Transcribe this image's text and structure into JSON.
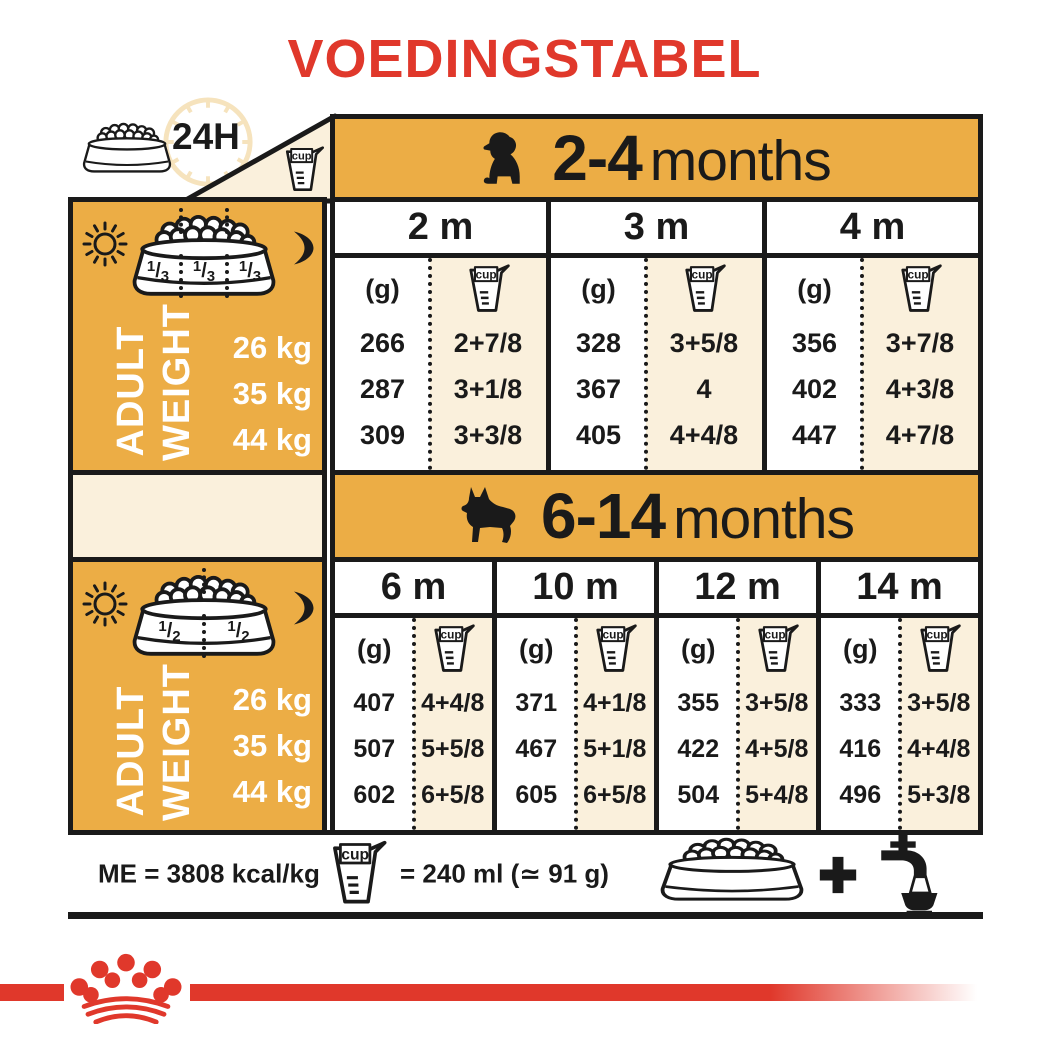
{
  "title": "VOEDINGSTABEL",
  "top_left": {
    "hours_label": "24H",
    "cup_label": "cup"
  },
  "row_header": {
    "line1": "ADULT",
    "line2": "WEIGHT"
  },
  "unit_g": "(g)",
  "sections": [
    {
      "age_bold": "2-4",
      "age_rest": "months",
      "dog_icon": "puppy-icon",
      "bowl_fractions": [
        "1/3",
        "1/3",
        "1/3"
      ],
      "weights": [
        "26 kg",
        "35 kg",
        "44 kg"
      ],
      "columns": [
        {
          "month": "2 m",
          "rows": [
            {
              "g": "266",
              "cup": "2+7/8"
            },
            {
              "g": "287",
              "cup": "3+1/8"
            },
            {
              "g": "309",
              "cup": "3+3/8"
            }
          ]
        },
        {
          "month": "3 m",
          "rows": [
            {
              "g": "328",
              "cup": "3+5/8"
            },
            {
              "g": "367",
              "cup": "4"
            },
            {
              "g": "405",
              "cup": "4+4/8"
            }
          ]
        },
        {
          "month": "4 m",
          "rows": [
            {
              "g": "356",
              "cup": "3+7/8"
            },
            {
              "g": "402",
              "cup": "4+3/8"
            },
            {
              "g": "447",
              "cup": "4+7/8"
            }
          ]
        }
      ]
    },
    {
      "age_bold": "6-14",
      "age_rest": "months",
      "dog_icon": "german-shepherd-icon",
      "bowl_fractions": [
        "1/2",
        "1/2"
      ],
      "weights": [
        "26 kg",
        "35 kg",
        "44 kg"
      ],
      "columns": [
        {
          "month": "6 m",
          "rows": [
            {
              "g": "407",
              "cup": "4+4/8"
            },
            {
              "g": "507",
              "cup": "5+5/8"
            },
            {
              "g": "602",
              "cup": "6+5/8"
            }
          ]
        },
        {
          "month": "10 m",
          "rows": [
            {
              "g": "371",
              "cup": "4+1/8"
            },
            {
              "g": "467",
              "cup": "5+1/8"
            },
            {
              "g": "605",
              "cup": "6+5/8"
            }
          ]
        },
        {
          "month": "12 m",
          "rows": [
            {
              "g": "355",
              "cup": "3+5/8"
            },
            {
              "g": "422",
              "cup": "4+5/8"
            },
            {
              "g": "504",
              "cup": "5+4/8"
            }
          ]
        },
        {
          "month": "14 m",
          "rows": [
            {
              "g": "333",
              "cup": "3+5/8"
            },
            {
              "g": "416",
              "cup": "4+4/8"
            },
            {
              "g": "496",
              "cup": "5+3/8"
            }
          ]
        }
      ]
    }
  ],
  "footer": {
    "me_label": "ME = 3808 kcal/kg",
    "cup_equiv": "= 240 ml (≃ 91 g)"
  },
  "colors": {
    "red": "#e0382b",
    "gold": "#ecad45",
    "cream": "#faf0dc",
    "ink": "#1a1a1a"
  }
}
